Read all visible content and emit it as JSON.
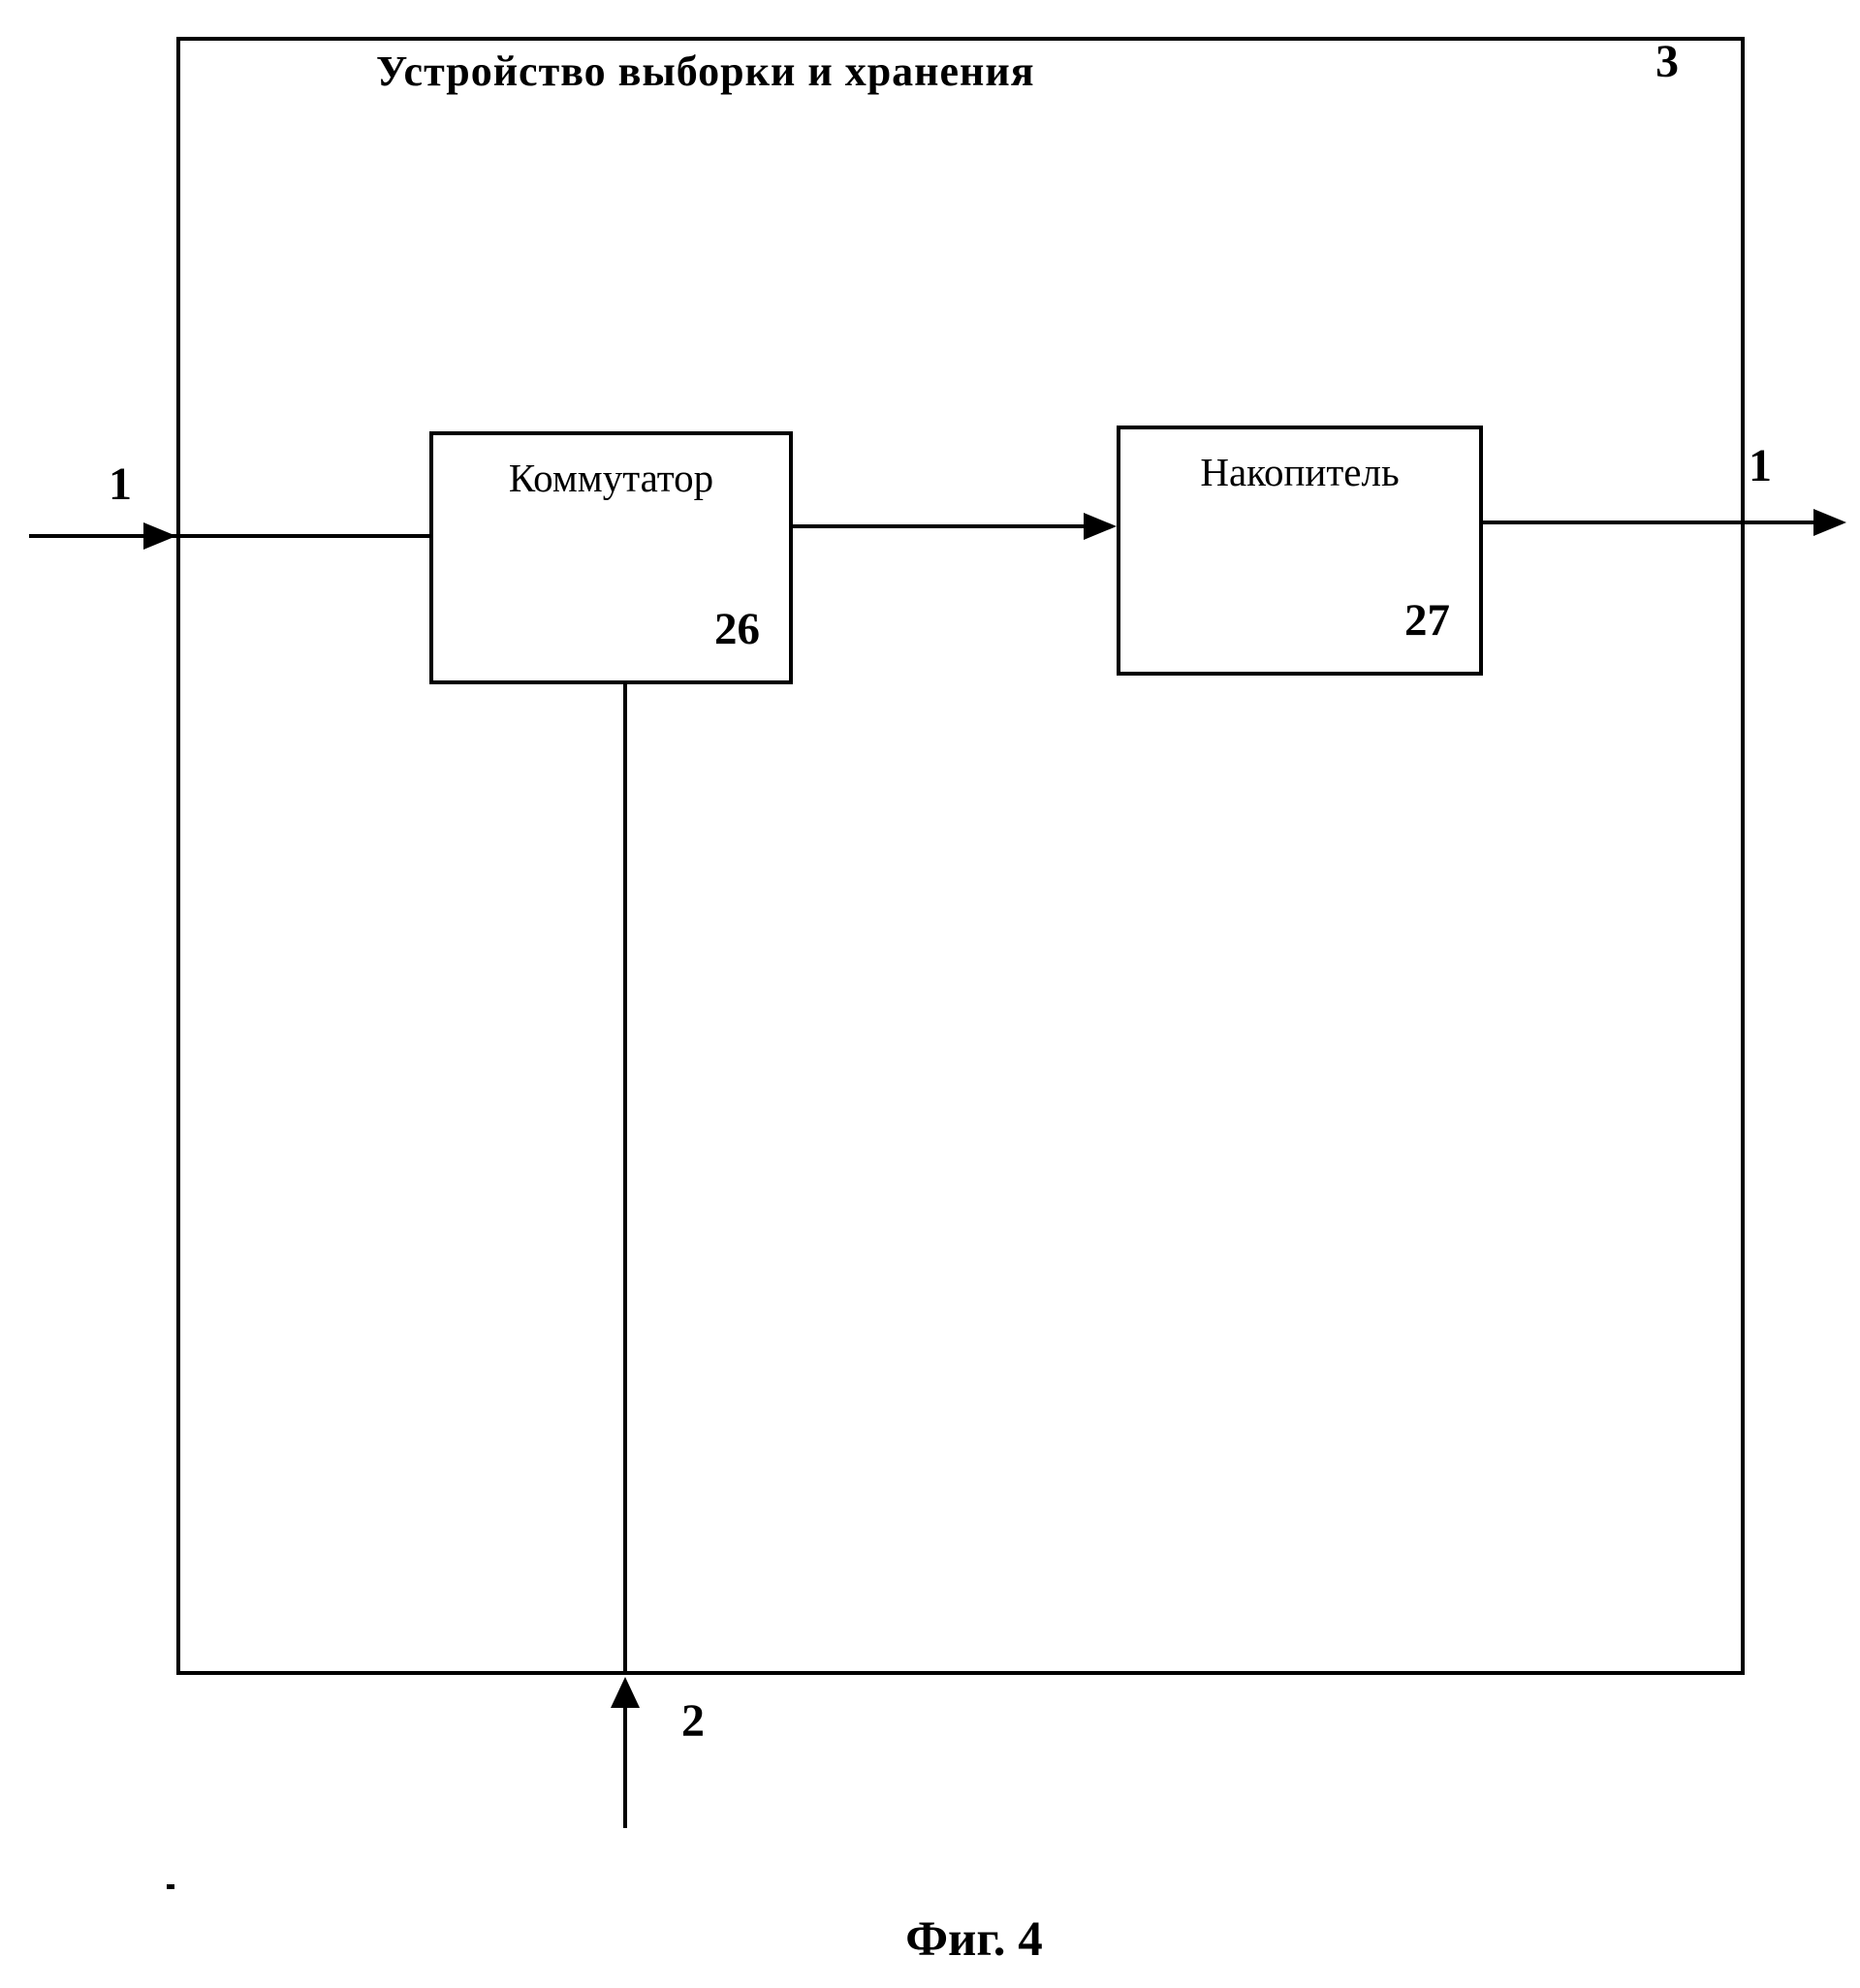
{
  "diagram": {
    "title": "Устройство выборки и хранения",
    "device_number": "3",
    "blocks": [
      {
        "label": "Коммутатор",
        "number": "26"
      },
      {
        "label": "Накопитель",
        "number": "27"
      }
    ],
    "ports": {
      "input_label": "1",
      "output_label": "1",
      "control_label": "2"
    },
    "caption": "Фиг. 4"
  }
}
